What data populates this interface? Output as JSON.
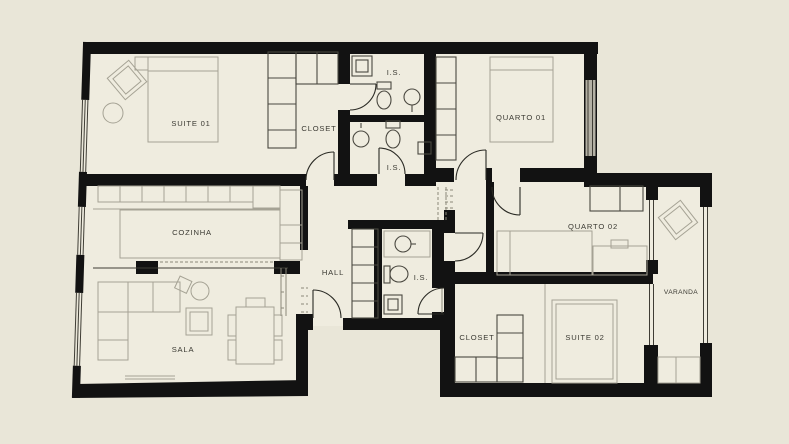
{
  "palette": {
    "background": "#e9e6d8",
    "floor": "#efecdf",
    "wall": "#121212",
    "furniture_line": "#a5a294",
    "cabinet_line": "#4a4840",
    "window_line": "#3f3d35",
    "door_line": "#2a2a24",
    "window_glass": "#b4b1a5",
    "hatch": "#8b887a",
    "label_text": "#3a3932"
  },
  "rooms": [
    {
      "id": "suite-01",
      "label": "SUITE 01"
    },
    {
      "id": "closet-1",
      "label": "CLOSET"
    },
    {
      "id": "is-1",
      "label": "I.S."
    },
    {
      "id": "quarto-01",
      "label": "QUARTO 01"
    },
    {
      "id": "is-2",
      "label": "I.S."
    },
    {
      "id": "cozinha",
      "label": "COZINHA"
    },
    {
      "id": "hall",
      "label": "HALL"
    },
    {
      "id": "is-3",
      "label": "I.S."
    },
    {
      "id": "quarto-02",
      "label": "QUARTO 02"
    },
    {
      "id": "varanda",
      "label": "VARANDA"
    },
    {
      "id": "closet-2",
      "label": "CLOSET"
    },
    {
      "id": "suite-02",
      "label": "SUITE 02"
    },
    {
      "id": "sala",
      "label": "SALA"
    }
  ]
}
